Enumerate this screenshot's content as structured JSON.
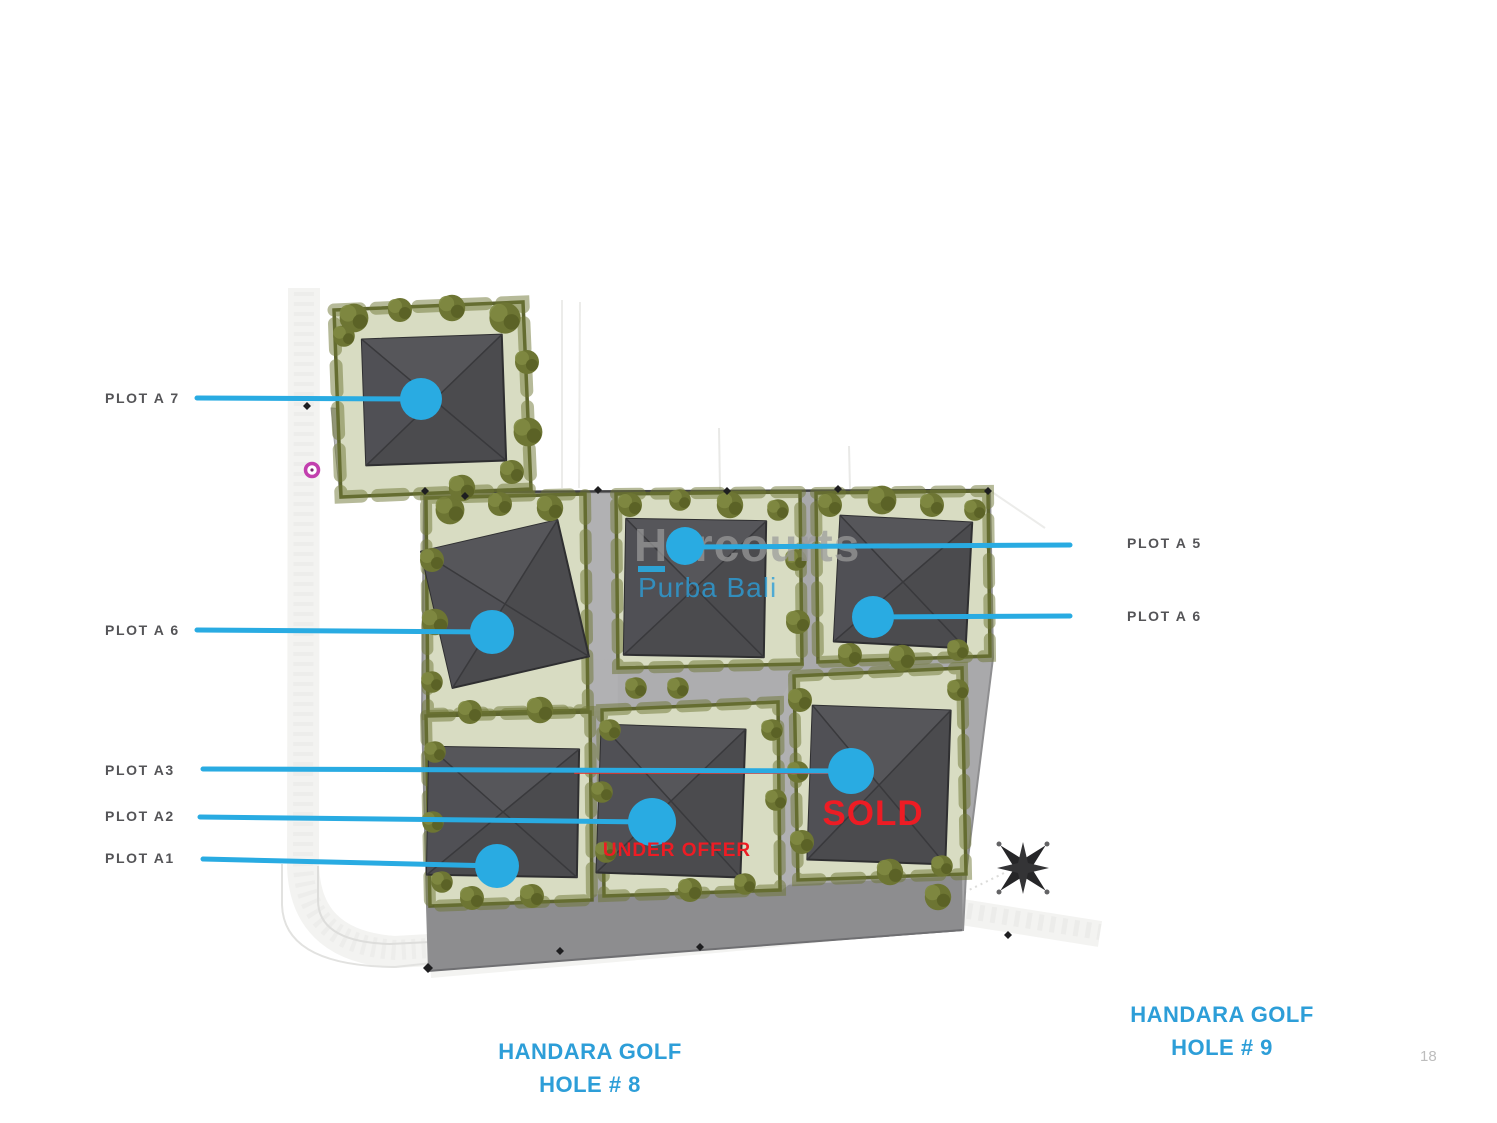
{
  "map": {
    "watermark": {
      "brand": "Harcourts",
      "subbrand": "Purba Bali"
    },
    "plot_labels": {
      "a7": "PLOT A 7",
      "a6_left": "PLOT A 6",
      "a3": "PLOT A3",
      "a2": "PLOT A2",
      "a1": "PLOT A1",
      "a5": "PLOT A 5",
      "a6_right": "PLOT A 6"
    },
    "status": {
      "sold": "SOLD",
      "under_offer": "UNDER OFFER"
    },
    "captions": {
      "hole8_line1": "HANDARA GOLF",
      "hole8_line2": "HOLE # 8",
      "hole9_line1": "HANDARA GOLF",
      "hole9_line2": "HOLE # 9"
    },
    "page_number": "18",
    "icons": {
      "compass": "compass-rose-icon",
      "gate_marker": "magenta-gate-marker",
      "boundary_marker": "survey-diamond-marker"
    },
    "colors": {
      "accent_blue": "#29abe2",
      "caption_blue": "#2d9ed8",
      "status_red": "#ed1c24",
      "label_gray": "#545457"
    }
  }
}
